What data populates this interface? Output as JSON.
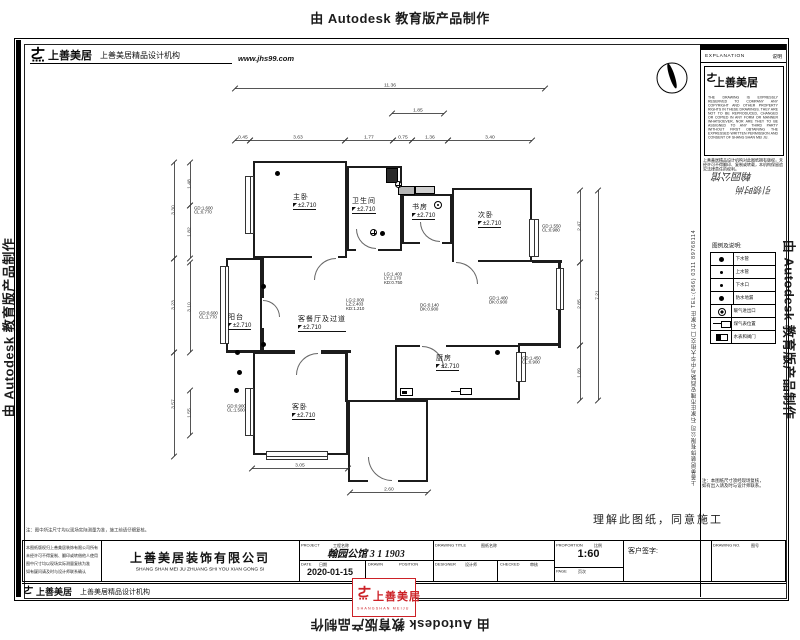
{
  "watermarks": {
    "text": "由 Autodesk 教育版产品制作"
  },
  "header": {
    "logo": "上善美居",
    "org": "上善美居精品设计机构",
    "website": "www.jhs99.com"
  },
  "approval_note": "理解此图纸，同意施工",
  "side_company": "上善美居装饰有限公司 石家庄市槐安西路与中华大街交口 石家庄 TEL:(866) 0311 89768114",
  "top_note": "注：图中所注尺寸均以现场实际测量为准，施工前请仔细复核。",
  "sidebar": {
    "explanation": "EXPLANATION",
    "explanation_cn": "说明",
    "logo": "上善美居",
    "copyright_en": "THE DRAWING IS EXPRESSLY RESERVED TO COMPANY ANY COPYRIGHT AND OTHER PROPERTY RIGHTS IN THESE DRAWINGS. THEY ARE NOT TO BE REPRODUCED, CHANGED OR COPIED IN ANY FORM OR MANNER WHATSOEVER, NOR ARE THEY TO BE ASSIGNED TO ANY THIRD PARTY WITHOUT FIRST OBTAINING THE EXPRESSED WRITTEN PERMISSION AND CONSENT OF SHANG SHAN MEI JU.",
    "copyright_cn": "上善美居精品设计机构对此图纸拥有版权，未经许可不得翻印、复制或转载，本机构保留追究法律责任的权利。",
    "stamp_line1": "翰园公馆",
    "stamp_line2": "引领时尚",
    "legend_title": "图例及说明:",
    "legend": [
      {
        "icon": "dot",
        "label": "下水管"
      },
      {
        "icon": "dot-sm",
        "label": "上水管"
      },
      {
        "icon": "dot-sm",
        "label": "下水口"
      },
      {
        "icon": "dot",
        "label": "防水地漏"
      },
      {
        "icon": "ring",
        "label": "暖气进出口"
      },
      {
        "icon": "gas",
        "label": "煤气表位置"
      },
      {
        "icon": "meter",
        "label": "水表和阀门"
      }
    ],
    "notes": [
      "注：本图纸尺寸须经现场复核，",
      "如有出入请及时与设计师联系。"
    ]
  },
  "titlebar": {
    "notes": [
      "本图纸版权归上善美居装饰有限公司所有",
      "未经许可不得复制、翻印或转借他人使用",
      "图中尺寸均以现场实际测量复核为准",
      "如有疑问请及时与设计师联系确认"
    ],
    "company": "上善美居装饰有限公司",
    "company_en": "SHANG SHAN MEI JU ZHUANG SHI YOU XIAN GONG SI",
    "project_label": "PROJECT",
    "project_label_cn": "工程名称",
    "project_value": "翰园公馆 3 1 1903",
    "date_label": "DATE",
    "date_label_cn": "日期",
    "date_value": "2020-01-15",
    "drawn_label": "DRAWN",
    "drawn_label_cn": "制图",
    "position_label": "POSITION",
    "position_label_cn": "部位",
    "title_label": "DRAWING TITLE",
    "title_label_cn": "图纸名称",
    "designer_label": "DESIGNER",
    "designer_label_cn": "设计师",
    "checker_label": "CHECKED",
    "checker_label_cn": "审核",
    "scale_label": "PROPORTION",
    "scale_label_cn": "比例",
    "scale_value": "1:60",
    "page_label": "PAGE",
    "page_label_cn": "页次",
    "sign_label": "客户签字:",
    "no_label": "DRAWING NO.",
    "no_label_cn": "图号"
  },
  "footer": {
    "logo": "上善美居",
    "org": "上善美居精品设计机构",
    "stamp": "上善美居",
    "stamp_sub": "SHANGSHAN MEIJU"
  },
  "plan": {
    "rooms": [
      {
        "x": 253,
        "y": 161,
        "w": 94,
        "h": 97
      },
      {
        "x": 347,
        "y": 166,
        "w": 55,
        "h": 85
      },
      {
        "x": 402,
        "y": 194,
        "w": 50,
        "h": 50
      },
      {
        "x": 452,
        "y": 188,
        "w": 80,
        "h": 74
      },
      {
        "x": 226,
        "y": 258,
        "w": 36,
        "h": 94
      },
      {
        "x": 253,
        "y": 352,
        "w": 95,
        "h": 103
      },
      {
        "x": 395,
        "y": 345,
        "w": 125,
        "h": 55
      },
      {
        "x": 348,
        "y": 400,
        "w": 80,
        "h": 82
      }
    ],
    "walls": [
      [
        261,
        258,
        3,
        96
      ],
      [
        226,
        350,
        125,
        3
      ],
      [
        345,
        352,
        3,
        50
      ],
      [
        532,
        260,
        30,
        3
      ],
      [
        558,
        260,
        3,
        88
      ],
      [
        518,
        343,
        42,
        3
      ]
    ],
    "gaps": [
      [
        312,
        256,
        26,
        6
      ],
      [
        356,
        249,
        22,
        5
      ],
      [
        420,
        242,
        22,
        5
      ],
      [
        454,
        260,
        24,
        6
      ],
      [
        295,
        350,
        26,
        6
      ],
      [
        420,
        343,
        26,
        5
      ],
      [
        262,
        298,
        4,
        30
      ],
      [
        368,
        480,
        30,
        5
      ]
    ],
    "windows": [
      [
        245,
        176,
        9,
        58
      ],
      [
        220,
        266,
        9,
        78
      ],
      [
        245,
        388,
        9,
        48
      ],
      [
        266,
        451,
        62,
        9
      ],
      [
        529,
        219,
        10,
        38
      ],
      [
        516,
        352,
        10,
        30
      ],
      [
        556,
        268,
        8,
        42
      ]
    ],
    "doors": [
      {
        "x": 314,
        "y": 258,
        "s": 22,
        "t": "tl"
      },
      {
        "x": 356,
        "y": 229,
        "s": 20,
        "t": "bl"
      },
      {
        "x": 420,
        "y": 222,
        "s": 20,
        "t": "bl"
      },
      {
        "x": 456,
        "y": 262,
        "s": 22,
        "t": "tr"
      },
      {
        "x": 296,
        "y": 353,
        "s": 22,
        "t": "tl"
      },
      {
        "x": 422,
        "y": 346,
        "s": 22,
        "t": "tr"
      },
      {
        "x": 263,
        "y": 300,
        "s": 17,
        "t": "tr"
      },
      {
        "x": 368,
        "y": 457,
        "s": 24,
        "t": "bl"
      }
    ],
    "shafts": [
      {
        "x": 386,
        "y": 168,
        "w": 12,
        "h": 15,
        "fill": "#2a2a2a"
      },
      {
        "x": 398,
        "y": 186,
        "w": 17,
        "h": 9,
        "fill": "#b5b5b5"
      },
      {
        "x": 415,
        "y": 186,
        "w": 20,
        "h": 8,
        "fill": "#cfcfcf"
      }
    ],
    "symbols": [
      {
        "t": "dot",
        "x": 277,
        "y": 173
      },
      {
        "t": "drain",
        "x": 398,
        "y": 184
      },
      {
        "t": "drain",
        "x": 373,
        "y": 232
      },
      {
        "t": "dot",
        "x": 382,
        "y": 233
      },
      {
        "t": "dot",
        "x": 263,
        "y": 286
      },
      {
        "t": "dot",
        "x": 263,
        "y": 344
      },
      {
        "t": "dot",
        "x": 237,
        "y": 352
      },
      {
        "t": "dot",
        "x": 239,
        "y": 372
      },
      {
        "t": "dot",
        "x": 236,
        "y": 390
      },
      {
        "t": "dot",
        "x": 497,
        "y": 352
      },
      {
        "t": "radiator",
        "x": 438,
        "y": 205
      },
      {
        "t": "gas",
        "x": 460,
        "y": 389
      },
      {
        "t": "meter",
        "x": 400,
        "y": 388
      }
    ],
    "labels": [
      {
        "x": 293,
        "y": 192,
        "name": "主卧",
        "elev": "±2.710"
      },
      {
        "x": 352,
        "y": 196,
        "name": "卫生间",
        "elev": "±2.710"
      },
      {
        "x": 412,
        "y": 202,
        "name": "书房",
        "elev": "±2.710"
      },
      {
        "x": 478,
        "y": 210,
        "name": "次卧",
        "elev": "±2.710"
      },
      {
        "x": 298,
        "y": 314,
        "name": "客餐厅及过道",
        "elev": "±2.710"
      },
      {
        "x": 228,
        "y": 312,
        "name": "阳台",
        "elev": "±2.710"
      },
      {
        "x": 292,
        "y": 402,
        "name": "客卧",
        "elev": "±2.710"
      },
      {
        "x": 436,
        "y": 353,
        "name": "厨房",
        "elev": "±2.710"
      }
    ],
    "annotations": [
      {
        "x": 194,
        "y": 206,
        "lines": [
          "GD:1.600",
          "CL:0.770"
        ]
      },
      {
        "x": 199,
        "y": 311,
        "lines": [
          "GD:0.600",
          "CL:1.770"
        ]
      },
      {
        "x": 542,
        "y": 224,
        "lines": [
          "GD:1.550",
          "CL:0.980"
        ]
      },
      {
        "x": 522,
        "y": 356,
        "lines": [
          "GD:1.450",
          "CL:0.900"
        ]
      },
      {
        "x": 227,
        "y": 404,
        "lines": [
          "GD:0.900",
          "CL:1.500"
        ]
      },
      {
        "x": 384,
        "y": 272,
        "lines": [
          "LG:1.403",
          "LY:2.170",
          "KD:0.750"
        ]
      },
      {
        "x": 346,
        "y": 298,
        "lines": [
          "LG:2.000",
          "LZ:2.403",
          "KD:1.210"
        ]
      },
      {
        "x": 420,
        "y": 303,
        "lines": [
          "DG:0.140",
          "DK:0.900"
        ]
      },
      {
        "x": 489,
        "y": 296,
        "lines": [
          "GD:1.400",
          "DK:0.900"
        ]
      }
    ],
    "dims": [
      {
        "o": "h",
        "x": 235,
        "y": 88,
        "len": 310,
        "label": "11.36"
      },
      {
        "o": "h",
        "x": 392,
        "y": 113,
        "len": 52,
        "label": "1.85"
      },
      {
        "o": "h",
        "x": 235,
        "y": 140,
        "len": 15,
        "label": "0.45"
      },
      {
        "o": "h",
        "x": 250,
        "y": 140,
        "len": 95,
        "label": "3.63"
      },
      {
        "o": "h",
        "x": 345,
        "y": 140,
        "len": 48,
        "label": "1.77"
      },
      {
        "o": "h",
        "x": 393,
        "y": 140,
        "len": 19,
        "label": "0.75"
      },
      {
        "o": "h",
        "x": 412,
        "y": 140,
        "len": 36,
        "label": "1.36"
      },
      {
        "o": "h",
        "x": 448,
        "y": 140,
        "len": 84,
        "label": "3.40"
      },
      {
        "o": "h",
        "x": 252,
        "y": 468,
        "len": 96,
        "label": "3.05"
      },
      {
        "o": "h",
        "x": 350,
        "y": 492,
        "len": 78,
        "label": "2.60"
      },
      {
        "o": "v",
        "x": 174,
        "y": 162,
        "len": 96,
        "label": "3.30"
      },
      {
        "o": "v",
        "x": 174,
        "y": 258,
        "len": 94,
        "label": "3.23"
      },
      {
        "o": "v",
        "x": 174,
        "y": 352,
        "len": 104,
        "label": "3.57"
      },
      {
        "o": "v",
        "x": 190,
        "y": 162,
        "len": 43,
        "label": "1.48"
      },
      {
        "o": "v",
        "x": 190,
        "y": 205,
        "len": 53,
        "label": "1.82"
      },
      {
        "o": "v",
        "x": 190,
        "y": 262,
        "len": 90,
        "label": "3.10"
      },
      {
        "o": "v",
        "x": 190,
        "y": 390,
        "len": 45,
        "label": "1.55"
      },
      {
        "o": "v",
        "x": 580,
        "y": 190,
        "len": 72,
        "label": "2.47"
      },
      {
        "o": "v",
        "x": 580,
        "y": 262,
        "len": 83,
        "label": "2.85"
      },
      {
        "o": "v",
        "x": 580,
        "y": 345,
        "len": 55,
        "label": "1.89"
      },
      {
        "o": "v",
        "x": 598,
        "y": 190,
        "len": 210,
        "label": "7.21"
      }
    ]
  }
}
